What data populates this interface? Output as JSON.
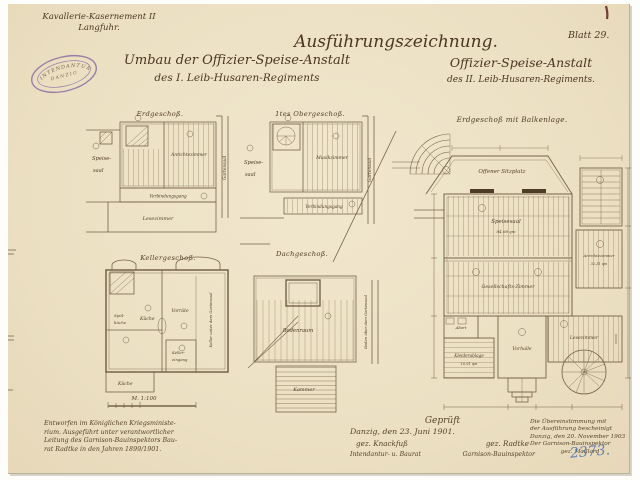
{
  "sheet": {
    "blatt": "Blatt 29.",
    "corner_line1": "Kavallerie-Kasernement II",
    "corner_line2": "Langfuhr.",
    "title": "Ausführungszeichnung.",
    "left_heading_line1": "Umbau der Offizier-Speise-Anstalt",
    "left_heading_line2": "des I. Leib-Husaren-Regiments",
    "right_heading_line1": "Offizier-Speise-Anstalt",
    "right_heading_line2": "des II. Leib-Husaren-Regiments.",
    "archive_number": "2373.",
    "stamp_line1": "INTENDANTUR",
    "stamp_line2": "DANZIG"
  },
  "plans": {
    "erdgeschoss": {
      "title": "Erdgeschoß.",
      "rooms": {
        "speise": "Speise-",
        "saal": "saal",
        "anrichte": "Anrichtezimmer",
        "gang": "Verbindungsgang",
        "lese": "Lesezimmer",
        "garten": "Gartensaal"
      }
    },
    "obergeschoss": {
      "title": "1tes Obergeschoß.",
      "rooms": {
        "speise": "Speise-",
        "saal": "saal",
        "musik": "Musikzimmer",
        "gang": "Verbindungsgang",
        "garten": "Gartensaal"
      }
    },
    "keller": {
      "title": "Kellergeschoß.",
      "scale": "M. 1:100",
      "rooms": {
        "spuel1": "Spül-",
        "spuel2": "küche",
        "kueche": "Küche",
        "vorraete": "Vorräte",
        "keller1": "Keller-",
        "keller2": "eingang",
        "kueche2": "Küche",
        "garten": "Keller unter dem Gartensaal"
      }
    },
    "dach": {
      "title": "Dachgeschoß.",
      "rooms": {
        "boden": "Bodenraum",
        "kammer": "Kammer",
        "garten": "Boden über dem Gartensaal"
      }
    },
    "balkenlage": {
      "title": "Erdgeschoß mit Balkenlage.",
      "rooms": {
        "sitzplatz": "Offener Sitzplatz",
        "speisesaal": "Speisesaal",
        "speisesaal_qm": "84,08 qm",
        "anrichte": "Anrichtezimmer",
        "anrichte_qm": "32,31 qm",
        "gesellschaft": "Gesellschafts-Zimmer",
        "vorhalle": "Vorhalle",
        "lese": "Lesezimmer",
        "abort": "Abort",
        "kleider": "Kleiderablage",
        "kleider_qm": "10,91 qm"
      }
    }
  },
  "notes": {
    "left_line1": "Entworfen im Königlichen Kriegsministe-",
    "left_line2": "rium. Ausgeführt unter verantwortlicher",
    "left_line3": "Leitung des Garnison-Bauinspektors Bau-",
    "left_line4": "rat Radtke in den Jahren 1899/1901.",
    "approval": {
      "gep": "Geprüft",
      "date": "Danzig, den 23. Juni 1901.",
      "sig1": "gez. Knackfuß",
      "sig2": "gez. Radtke",
      "title1": "Intendantur- u. Baurat",
      "title2": "Garnison-Bauinspektor"
    },
    "certify_line1": "Die Übereinstimmung mit",
    "certify_line2": "der Ausführung bescheinigt",
    "certify_line3": "Danzig, den 20. November 1903",
    "certify_line4": "Der Garnison-Bauinspektor",
    "certify_line5": "gez. Maillard"
  }
}
